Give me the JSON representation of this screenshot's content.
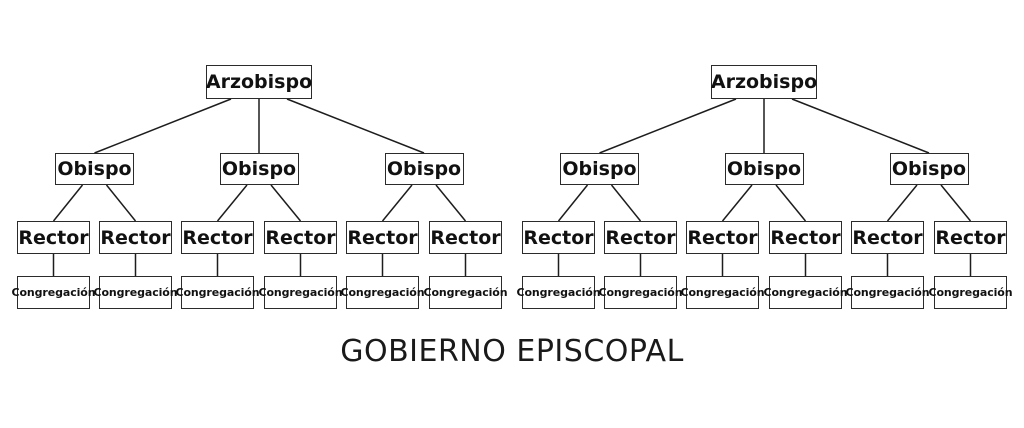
{
  "title": "GOBIERNO EPISCOPAL",
  "diagram": {
    "type": "hierarchy-tree",
    "tree_count": 2,
    "labels": {
      "level1": "Arzobispo",
      "level2": "Obispo",
      "level3": "Rector",
      "level4": "Congregación"
    },
    "hierarchy": {
      "level1_count_per_tree": 1,
      "level2_count_per_tree": 3,
      "level3_count_per_tree": 6,
      "level4_count_per_tree": 6
    }
  },
  "colors": {
    "background": "#ffffff",
    "box_fill": "#ffffff",
    "box_border": "#2b2b2b",
    "text": "#111111",
    "connector_line": "#1d1d1d"
  }
}
